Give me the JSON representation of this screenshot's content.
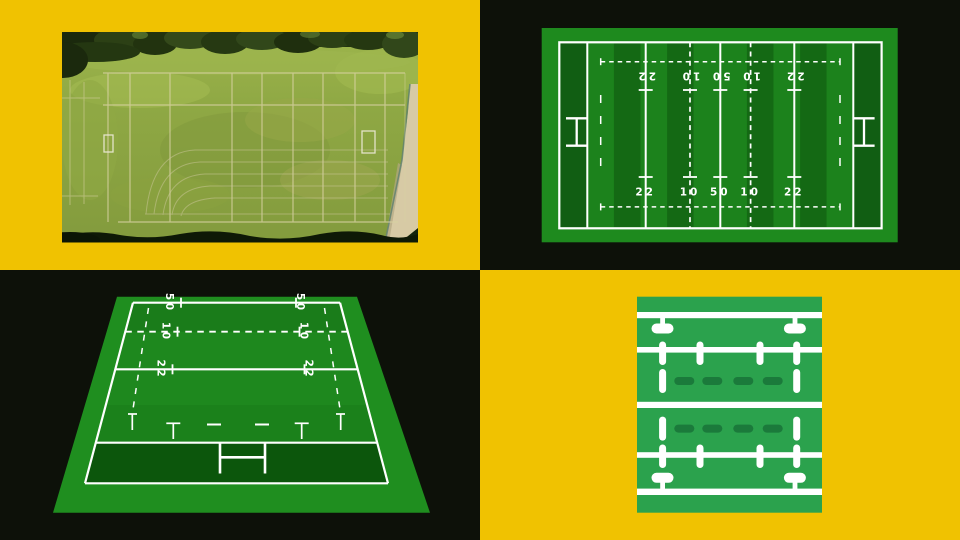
{
  "colors": {
    "background_yellow": "#F0C201",
    "background_black": "#0D1109",
    "diagram_field_green": "#1E8A1E",
    "diagram_stripe_light": "#1C821C",
    "diagram_stripe_dark": "#146914",
    "diagram_in_goal_green": "#115E13",
    "perspective_field_green": "#1F8E1F",
    "perspective_in_goal_green": "#0C560C",
    "line_white": "#FFFFFF",
    "icon_field_green": "#2BA24D",
    "icon_dash_green": "#1B7A3B",
    "photo_grass_green": "#8FA844"
  },
  "top_view_diagram": {
    "labels_top": [
      "22",
      "10",
      "50",
      "10",
      "22"
    ],
    "labels_bottom": [
      "22",
      "10",
      "50",
      "10",
      "22"
    ]
  },
  "perspective_diagram": {
    "labels_left": [
      "50",
      "10",
      "22"
    ],
    "labels_right": [
      "50",
      "10",
      "22"
    ]
  }
}
